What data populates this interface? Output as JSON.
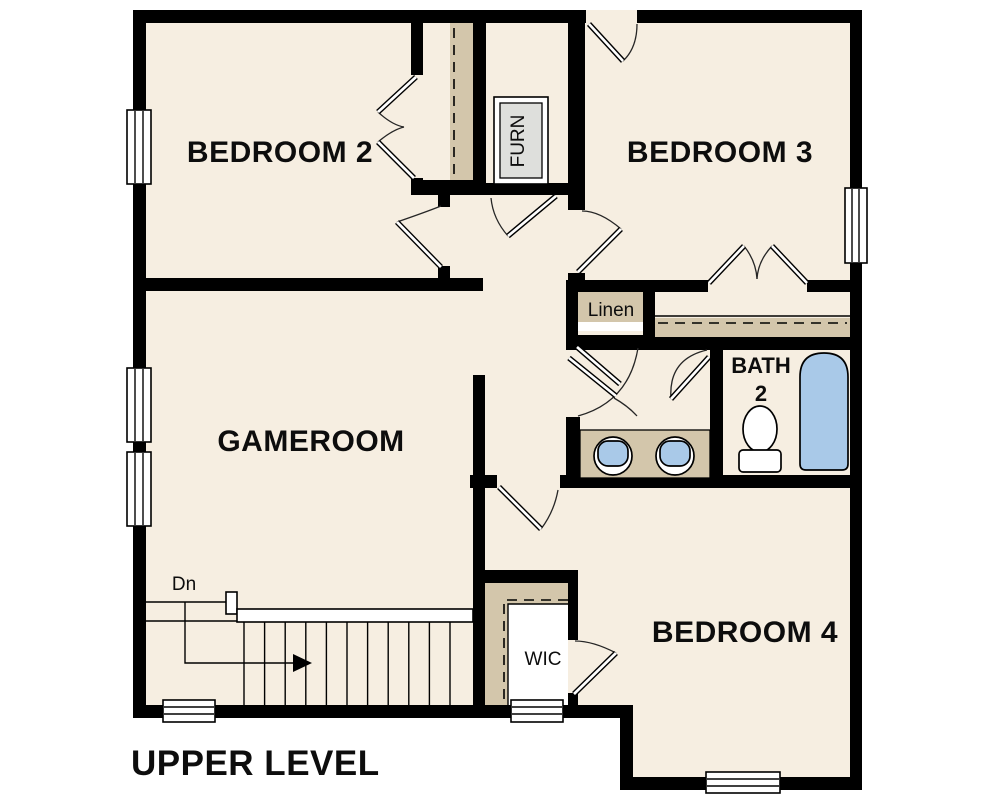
{
  "plan": {
    "title": "UPPER LEVEL",
    "rooms": {
      "bedroom2": {
        "label": "BEDROOM 2"
      },
      "bedroom3": {
        "label": "BEDROOM 3"
      },
      "gameroom": {
        "label": "GAMEROOM"
      },
      "bedroom4": {
        "label": "BEDROOM 4"
      },
      "bath2": {
        "label": "BATH",
        "number": "2"
      },
      "linen": {
        "label": "Linen"
      },
      "wic": {
        "label": "WIC"
      },
      "furnace": {
        "label": "FURN"
      }
    },
    "stairs": {
      "direction_label": "Dn",
      "tread_count": 11
    },
    "fixtures": [
      "bathtub",
      "toilet",
      "double-sink-vanity",
      "furnace-unit"
    ],
    "window_count": 7,
    "door_count": 10
  },
  "colors": {
    "paper": "#ffffff",
    "floor": "#f6eee1",
    "wall": "#000000",
    "shelf": "#d3c6ab",
    "fixture": "#a9c9e8",
    "furnace": "#dedfdc"
  }
}
